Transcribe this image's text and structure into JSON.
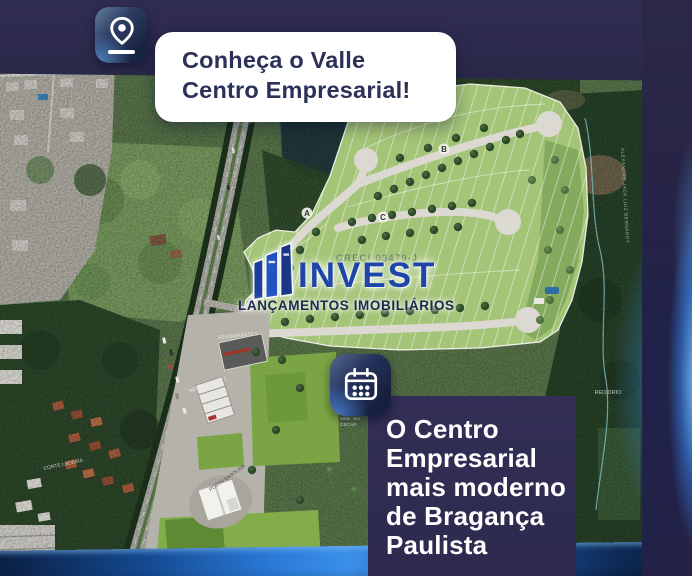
{
  "callout": {
    "icon": "location-pin",
    "line1": "Conheça o Valle",
    "line2": "Centro Empresarial!"
  },
  "logo": {
    "brand": "INVEST",
    "tagline": "LANÇAMENTOS IMOBILIÁRIOS",
    "creci": "CRECI 03479-J"
  },
  "headline": {
    "icon": "calendar",
    "lines": [
      "O Centro",
      "Empresarial",
      "mais moderno",
      "de Bragança",
      "Paulista"
    ]
  },
  "site_plan": {
    "street_a": "A",
    "street_b": "B",
    "street_c": "C",
    "restaurante_1": "RESTAURANTE 1",
    "restaurante_2": "RESTAURANTE 2",
    "posto_gasolina": "POSTO GASOLINA"
  },
  "map_labels": {
    "road_top": "ALEXANDRE JACK LUIZ",
    "road_right": "ALEXANDRE JACK LUIZ BERNARDT",
    "ladeira": "CORTE LADEIRA",
    "place_line1": "Valle, Bm",
    "place_line2": "CECAP",
    "rio": "REDIDRIO"
  },
  "colors": {
    "navy_band": "#2b2947",
    "panel_navy": "#302c52",
    "accent_blue": "#2f86e0",
    "card_text": "#2b3157",
    "logo_blue": "#1e46aa",
    "site_green": "#a4c477",
    "road_grey": "#dcd9d2"
  }
}
